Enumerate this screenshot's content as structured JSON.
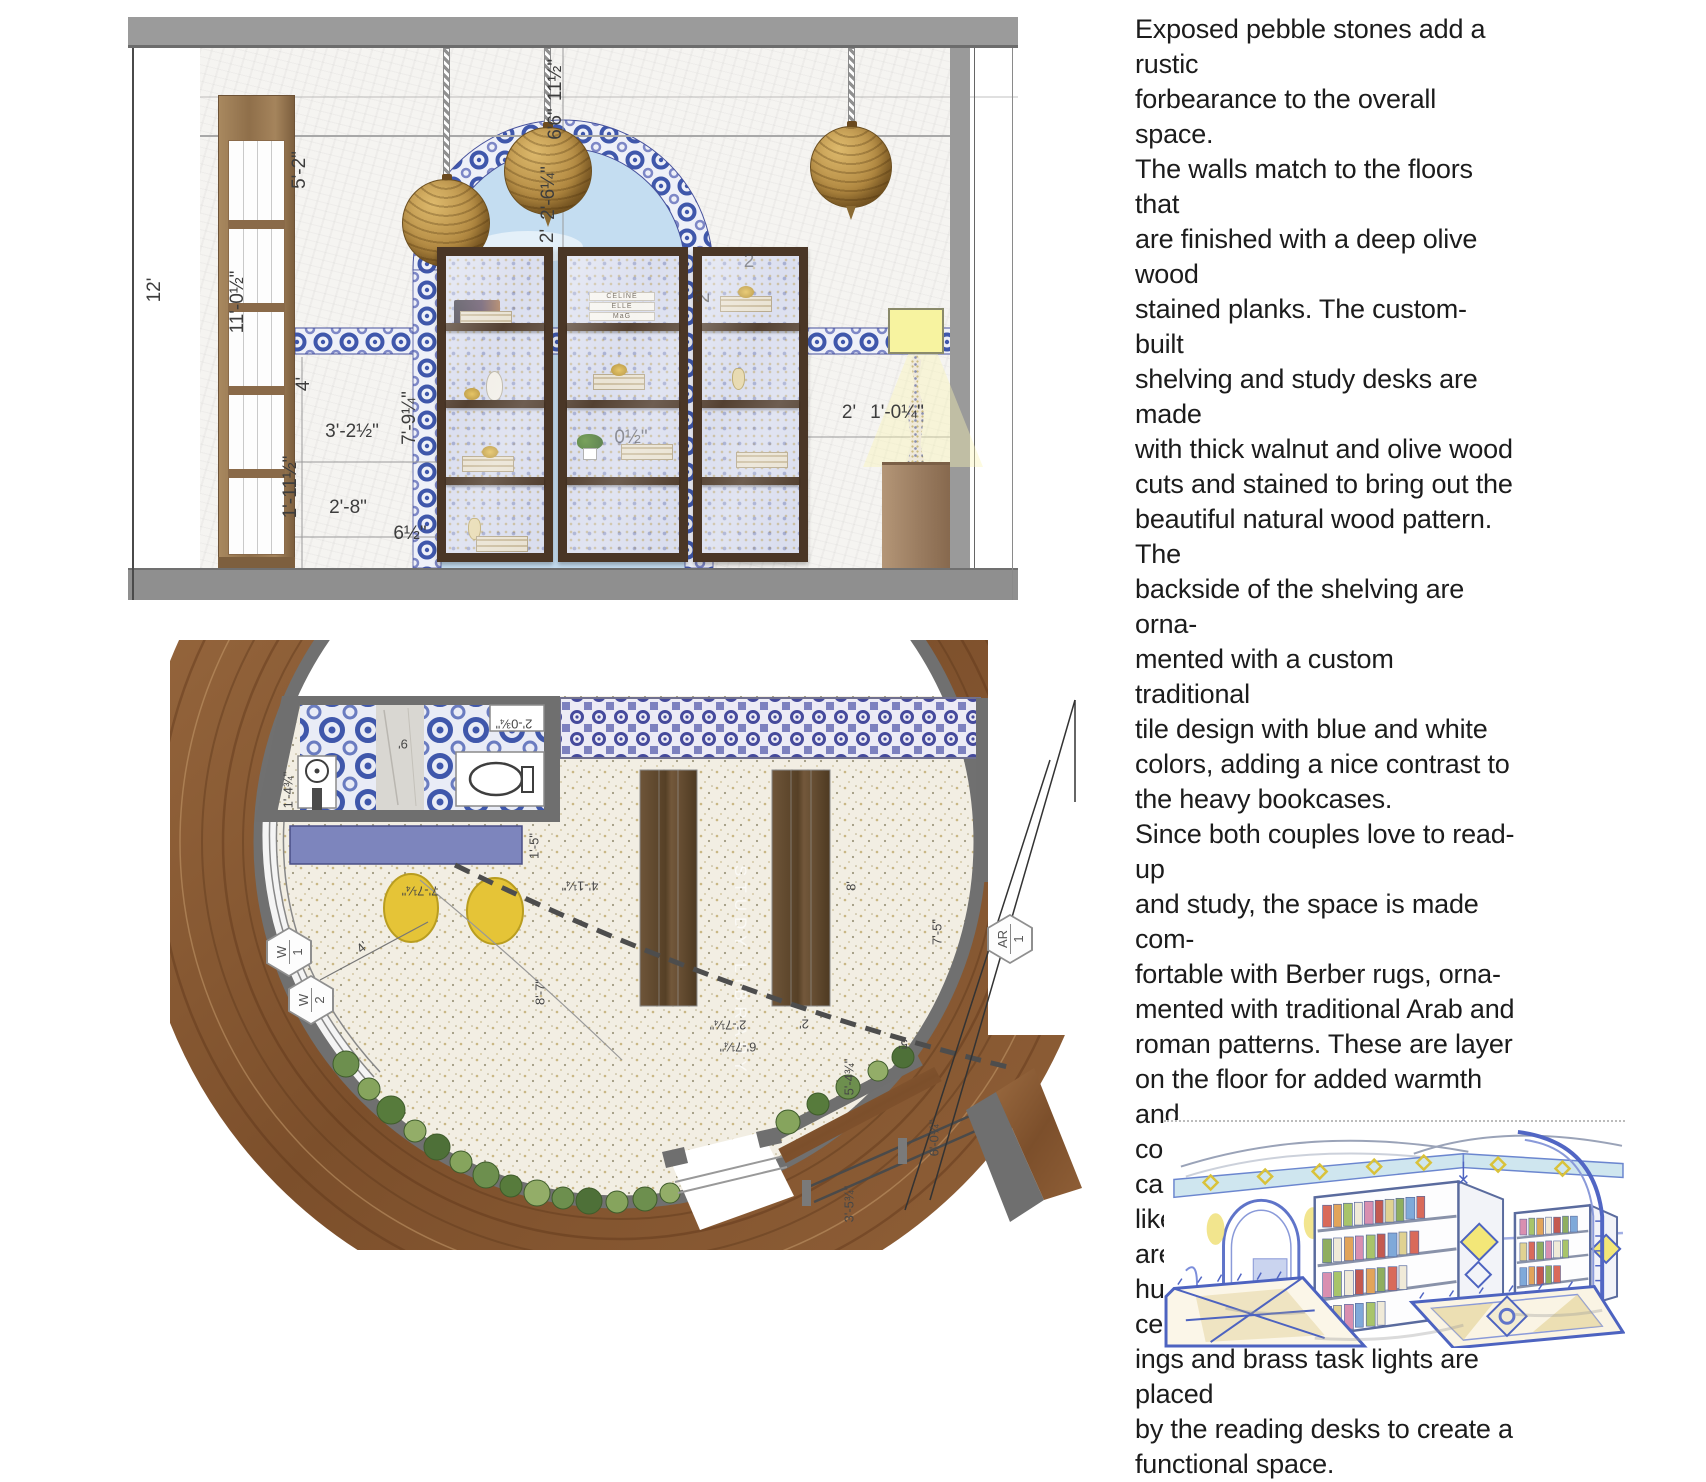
{
  "palette": {
    "ceiling_gray": "#9b9b9b",
    "floor_gray": "#8f8f8f",
    "tile_blue": "#3f57ab",
    "sky_blue": "#c4ddf1",
    "wood_brown": "#8a5a38",
    "pouf_yellow": "#e5c437",
    "violet_bench": "#7d85bd",
    "lamp_yellow": "#f7f3a0",
    "pendant_gold": "#b38a42"
  },
  "elevation": {
    "book_titles": [
      "CELINE",
      "ELLE",
      "MaG"
    ],
    "dimensions": [
      {
        "t": "12'",
        "x": 155,
        "y": 290,
        "r": -90,
        "s": "edim"
      },
      {
        "t": "11'-0½\"",
        "x": 238,
        "y": 302,
        "r": -90,
        "s": "edim"
      },
      {
        "t": "5'-2\"",
        "x": 300,
        "y": 170,
        "r": -90,
        "s": "edim"
      },
      {
        "t": "11½\"",
        "x": 556,
        "y": 80,
        "r": -90,
        "s": "edim"
      },
      {
        "t": "6'6\"",
        "x": 556,
        "y": 124,
        "r": -90,
        "s": "edim"
      },
      {
        "t": "2'-6¼\"",
        "x": 549,
        "y": 193,
        "r": -90,
        "s": "edim"
      },
      {
        "t": "2'",
        "x": 548,
        "y": 236,
        "r": -90,
        "s": "edim"
      },
      {
        "t": "7'-9¼\"",
        "x": 410,
        "y": 418,
        "r": -90,
        "s": "edim"
      },
      {
        "t": "4'",
        "x": 304,
        "y": 384,
        "r": -90,
        "s": "edim"
      },
      {
        "t": "3'-2½\"",
        "x": 352,
        "y": 432,
        "r": 0,
        "s": "edim"
      },
      {
        "t": "1'-11½\"",
        "x": 291,
        "y": 487,
        "r": -90,
        "s": "edim"
      },
      {
        "t": "2'-8\"",
        "x": 348,
        "y": 508,
        "r": 0,
        "s": "edim"
      },
      {
        "t": "6½\"",
        "x": 410,
        "y": 534,
        "r": 0,
        "s": "edim"
      },
      {
        "t": "2",
        "x": 749,
        "y": 262,
        "r": 0,
        "s": "edim",
        "f": 1
      },
      {
        "t": "2'",
        "x": 704,
        "y": 296,
        "r": -90,
        "s": "edim",
        "f": 1
      },
      {
        "t": "0½\"",
        "x": 631,
        "y": 438,
        "r": 0,
        "s": "edim",
        "f": 1
      },
      {
        "t": "2'",
        "x": 849,
        "y": 413,
        "r": 0,
        "s": "edim"
      },
      {
        "t": "1'-0¼\"",
        "x": 897,
        "y": 413,
        "r": 0,
        "s": "edim"
      }
    ]
  },
  "plan": {
    "watermark": "STUDY LIBRARY",
    "dimensions": [
      {
        "t": "9'",
        "x": 403,
        "y": 744,
        "r": 180,
        "s": "pdim"
      },
      {
        "t": "2'-0¾\"",
        "x": 514,
        "y": 724,
        "r": 180,
        "s": "pdim"
      },
      {
        "t": "1'-4¾\"",
        "x": 288,
        "y": 790,
        "r": -90,
        "s": "pdim"
      },
      {
        "t": "1'-5\"",
        "x": 534,
        "y": 846,
        "r": -90,
        "s": "pdim"
      },
      {
        "t": "7'-7¼\"",
        "x": 420,
        "y": 891,
        "r": 180,
        "s": "pdim"
      },
      {
        "t": "4'-1¼\"",
        "x": 580,
        "y": 886,
        "r": 180,
        "s": "pdim"
      },
      {
        "t": "4'",
        "x": 362,
        "y": 947,
        "r": -40,
        "s": "pdim"
      },
      {
        "t": "8'-7\"",
        "x": 540,
        "y": 992,
        "r": -90,
        "s": "pdim"
      },
      {
        "t": "8'",
        "x": 851,
        "y": 886,
        "r": -90,
        "s": "pdim"
      },
      {
        "t": "7'-5\"",
        "x": 937,
        "y": 932,
        "r": -90,
        "s": "pdim"
      },
      {
        "t": "2'-7¼\"",
        "x": 728,
        "y": 1025,
        "r": 180,
        "s": "pdim"
      },
      {
        "t": "2'",
        "x": 804,
        "y": 1024,
        "r": 180,
        "s": "pdim"
      },
      {
        "t": "6'-7¼\"",
        "x": 738,
        "y": 1047,
        "r": 180,
        "s": "pdim"
      },
      {
        "t": "5'",
        "x": 903,
        "y": 1044,
        "r": 180,
        "s": "pdim"
      },
      {
        "t": "5'-4¾\"",
        "x": 849,
        "y": 1077,
        "r": -90,
        "s": "pdim"
      },
      {
        "t": "6'-0¾\"",
        "x": 934,
        "y": 1138,
        "r": -90,
        "s": "pdim"
      },
      {
        "t": "3'-5¾\"",
        "x": 849,
        "y": 1204,
        "r": -90,
        "s": "pdim"
      }
    ],
    "markers": [
      {
        "top": "W",
        "bottom": "1",
        "x": 289,
        "y": 952
      },
      {
        "top": "W",
        "bottom": "2",
        "x": 311,
        "y": 1000
      },
      {
        "top": "AR",
        "bottom": "1",
        "x": 1010,
        "y": 939
      }
    ]
  },
  "article": {
    "lines": [
      "Exposed pebble stones add a rustic",
      "forbearance to the overall space.",
      "The walls match to the floors that",
      "are finished with a deep olive wood",
      "stained planks. The custom- built",
      "shelving and study desks are made",
      "with thick walnut and olive wood",
      "cuts and stained to bring out the",
      "beautiful natural wood pattern. The",
      "backside of the shelving are orna-",
      "mented with a custom traditional",
      "tile design with blue and white",
      "colors, adding a nice contrast to",
      "the heavy bookcases.",
      "Since both couples love to read-up",
      "and study, the space is made com-",
      "fortable with Berber rugs, orna-",
      "mented with traditional Arab and",
      "roman patterns. These are layer",
      "on the floor for added warmth and",
      "comfort. During dawn, bird-cage-",
      "like traditional lighting fixtures are",
      "hung from the cross-vaulted ceil-",
      "ings and brass task lights are placed",
      "by the reading desks to create a",
      "functional space."
    ]
  }
}
